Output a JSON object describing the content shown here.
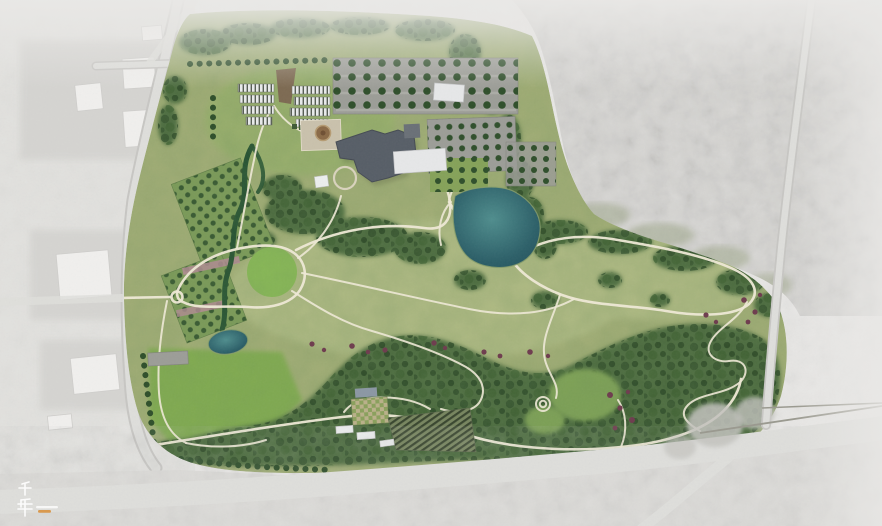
{
  "watermark": {
    "text": "千年",
    "char_top": "千",
    "char_bottom": "年"
  },
  "colors": {
    "bg": "#e8e7e5",
    "surround": "#dcdbd8",
    "surroundDark": "#c3c2be",
    "neBlock": "#d6d5d2",
    "road": "#dededb",
    "roadEdge": "#c7c6c3",
    "roadThin": "#9a998f",
    "lotPad": "#d3d2cf",
    "buildingWhite": "#f0efed",
    "buildingEdge": "#cfcecb",
    "meadow": "#a6b078",
    "meadowLight": "#b4bd86",
    "lawn": "#8abc55",
    "lawnSW": "#83ae50",
    "wood": "#47663a",
    "canopyA": "#2d4a28",
    "canopyB": "#223e1f",
    "canopyC": "#3a5c2f",
    "clearing": "#7fa355",
    "orchardBg": "#7d9c58",
    "orchardTree": "#2e4f2a",
    "hedge": "#1e4b2d",
    "pondEdge": "#8ba06b",
    "pond1": "#4f8d8d",
    "pond2": "#2c5f68",
    "pond3": "#24525c",
    "path": "#eee9d6",
    "parking": "#9c9d97",
    "parkingTree": "#2f4f2b",
    "roofDark": "#575e67",
    "roofDarkEdge": "#454b53",
    "roofWhite": "#e6e7e8",
    "annexGray": "#6a7077",
    "plaza": "#c9c1ac",
    "medallion": "#8a6a47",
    "medallionRing": "#b59b72",
    "shrub": "#6e3c4e",
    "blossom": "#c08ba0",
    "ghDark": "#555c52",
    "ghLight": "#e8eaea",
    "ghBrown": "#7d6a52",
    "coldframe": "#3e5a36",
    "solarA": "#77855f",
    "solarB": "#39462f",
    "gardenA": "#8aa05c",
    "gardenB": "#b9b089",
    "shedBlue": "#8b97a3",
    "shedWhite": "#eceeee",
    "fade": "#e9e8e6",
    "watermark": "#ffffff",
    "watermarkAccent": "#d8913f"
  }
}
